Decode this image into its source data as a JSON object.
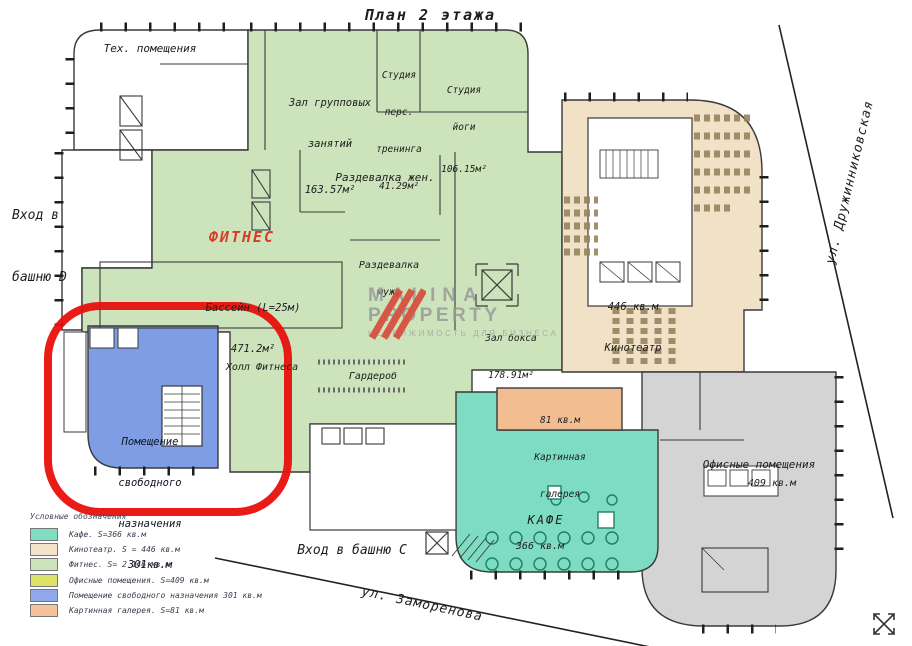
{
  "title": "План 2 этажа",
  "streets": {
    "right": "ул. Дружинниковская",
    "bottom": "ул. Заморенова"
  },
  "entrances": {
    "d_line1": "Вход в",
    "d_line2": "башню D",
    "c": "Вход в башню C"
  },
  "watermark": {
    "line1": "MALINA",
    "line2": "PROPERTY",
    "tagline": "НЕДВИЖИМОСТЬ ДЛЯ БИЗНЕСА"
  },
  "rooms": {
    "tech": "Тех. помещения",
    "group_hall": {
      "l1": "Зал групповых",
      "l2": "занятий",
      "area": "163.57м²"
    },
    "personal": {
      "l1": "Студия",
      "l2": "перс.",
      "l3": "тренинга",
      "area": "41.29м²"
    },
    "yoga": {
      "l1": "Студия",
      "l2": "йоги",
      "area": "106.15м²"
    },
    "locker_w": "Раздевалка жен.",
    "fitness_title": "ФИТНЕС",
    "pool": {
      "l1": "Бассейн (L=25м)",
      "area": "471.2м²"
    },
    "locker_m": {
      "l1": "Раздевалка",
      "l2": "муж."
    },
    "boxing": {
      "l1": "Зал бокса",
      "area": "178.91м²"
    },
    "fitness_hall": "Холл Фитнеса",
    "wardrobe": "Гардероб",
    "cinema": {
      "area": "446 кв.м",
      "l1": "Кинотеатр"
    },
    "gallery": {
      "area": "81 кв.м",
      "l1": "Картинная",
      "l2": "галерея"
    },
    "cafe": {
      "l1": "КАФЕ",
      "area": "366 кв.м"
    },
    "offices": {
      "l1": "Офисные помещения",
      "area": "409 кв.м"
    },
    "free_room": {
      "l1": "Помещение",
      "l2": "свободного",
      "l3": "назначения",
      "area": "301кв.м"
    }
  },
  "legend": {
    "header": "Условные обозначения",
    "items": [
      {
        "label": "Кафе. S=366 кв.м",
        "color": "#7fdec2"
      },
      {
        "label": "Кинотеатр. S = 446 кв.м",
        "color": "#f3e3cb"
      },
      {
        "label": "Фитнес. S= 2 146 кв.м",
        "color": "#cbe4bb"
      },
      {
        "label": "Офисные помещения. S=409 кв.м",
        "color": "#dde269"
      },
      {
        "label": "Помещение свободного назначения 301 кв.м",
        "color": "#8fa8ea"
      },
      {
        "label": "Картинная галерея. S=81 кв.м",
        "color": "#f6c29c"
      }
    ]
  },
  "colors": {
    "fitness": "#cde3bb",
    "cinema": "#f1e1c6",
    "cafe": "#7ddcc1",
    "offices_zone": "#d4d4d4",
    "free_room": "#7e9de4",
    "gallery": "#f3bd92",
    "highlight": "#e8100c",
    "logo_red": "#d9392b",
    "walls": "#3a3a3a"
  }
}
